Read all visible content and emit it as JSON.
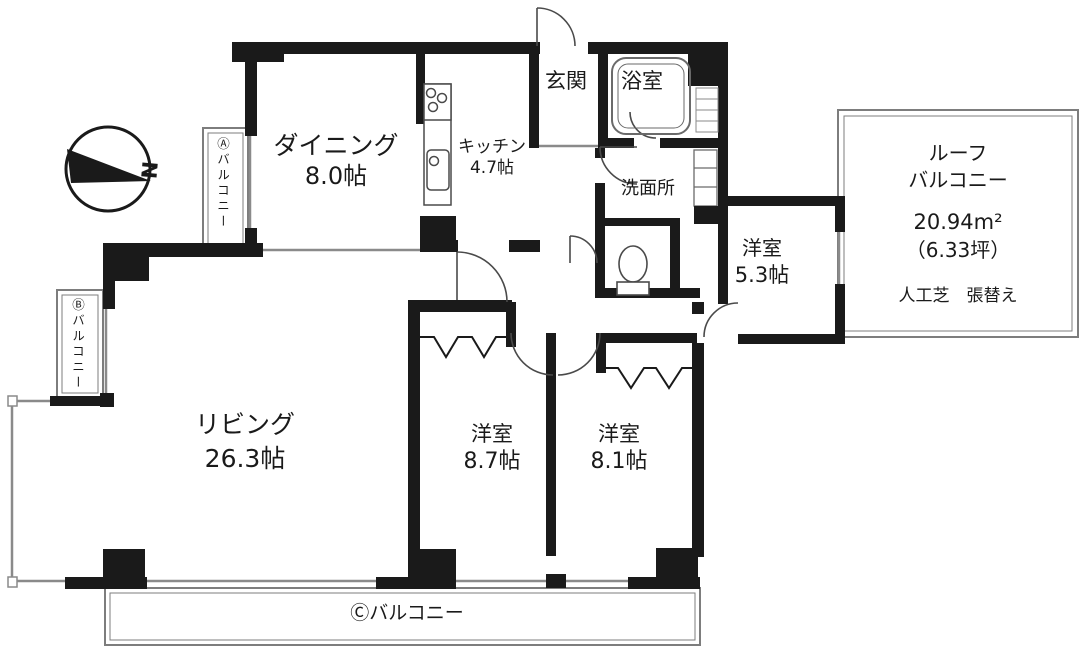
{
  "compass": {
    "label": "N"
  },
  "rooms": {
    "dining": {
      "name": "ダイニング",
      "size": "8.0帖"
    },
    "kitchen": {
      "name": "キッチン",
      "size": "4.7帖"
    },
    "entrance": {
      "name": "玄関"
    },
    "bathroom": {
      "name": "浴室"
    },
    "washroom": {
      "name": "洗面所"
    },
    "western_room_5_3": {
      "name": "洋室",
      "size": "5.3帖"
    },
    "living": {
      "name": "リビング",
      "size": "26.3帖"
    },
    "western_room_8_7": {
      "name": "洋室",
      "size": "8.7帖"
    },
    "western_room_8_1": {
      "name": "洋室",
      "size": "8.1帖"
    }
  },
  "balconies": {
    "a": {
      "label": "Ⓐバルコニー"
    },
    "b": {
      "label": "Ⓑバルコニー"
    },
    "c": {
      "label": "Ⓒバルコニー"
    },
    "roof": {
      "name_line1": "ルーフ",
      "name_line2": "バルコニー",
      "area_sqm": "20.94m²",
      "area_tsubo": "（6.33坪）",
      "note": "人工芝　張替え"
    }
  },
  "colors": {
    "wall": "#1a1a1a",
    "thin_line": "#8a8a8a",
    "background": "#ffffff"
  }
}
